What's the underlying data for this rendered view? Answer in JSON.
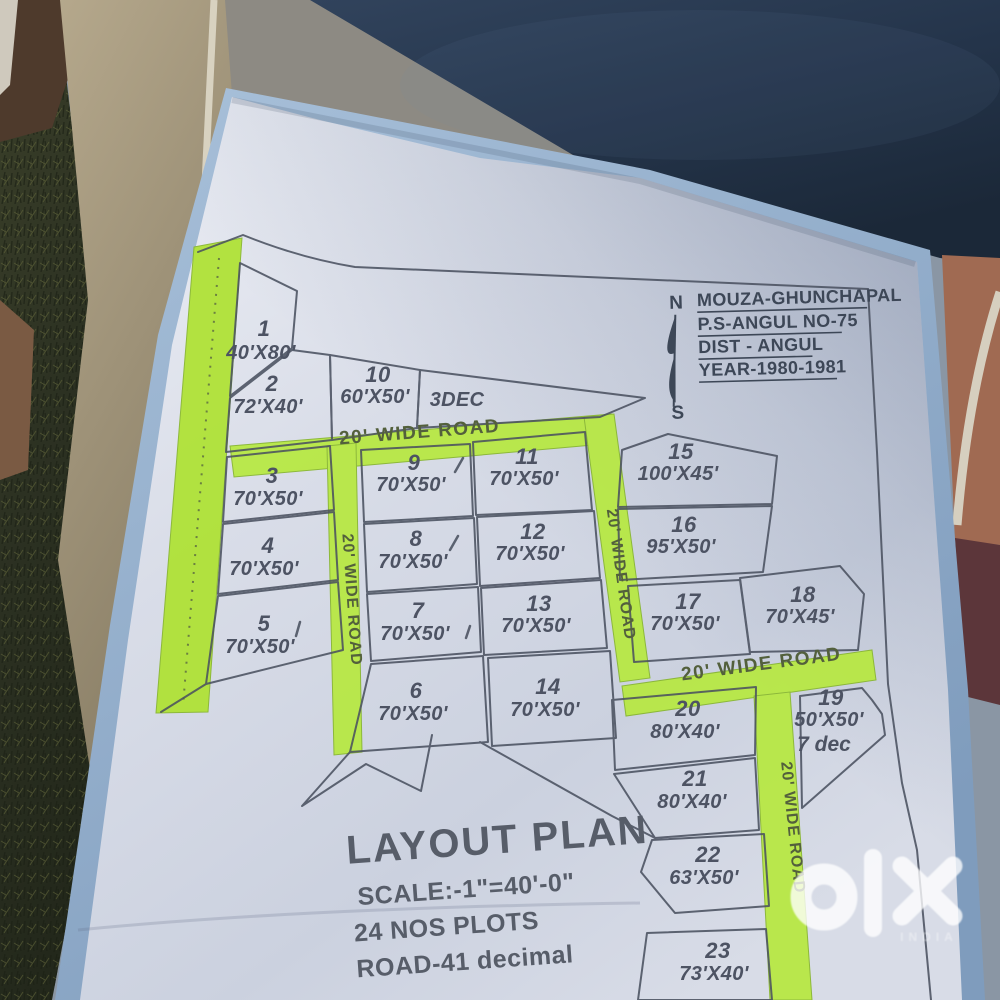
{
  "colors": {
    "highlight_green": "#b4e43b",
    "paper": "#dde1ec",
    "ink": "#4a5160",
    "fabric_navy": "#24344a",
    "grass_dark": "#2c3122",
    "chair_tan": "#ac9f84",
    "board_blue": "#9db7d2",
    "watermark_white": "#ffffff"
  },
  "title_block": {
    "north": "N",
    "south": "S",
    "line1": "MOUZA-GHUNCHAPAL",
    "line2": "P.S-ANGUL NO-75",
    "line3": "DIST - ANGUL",
    "line4": "YEAR-1980-1981"
  },
  "legend": {
    "title": "LAYOUT PLAN",
    "scale": "SCALE:-1\"=40'-0\"",
    "plots": "24 NOS PLOTS",
    "road": "ROAD-41 decimal"
  },
  "roads": [
    "20' WIDE ROAD",
    "20' WIDE ROAD",
    "20' WIDE ROAD",
    "20' WIDE ROAD",
    "20' WIDE ROAD"
  ],
  "plots": [
    {
      "no": "1",
      "size": "40'X80'"
    },
    {
      "no": "2",
      "size": "72'X40'"
    },
    {
      "no": "3",
      "size": "70'X50'"
    },
    {
      "no": "4",
      "size": "70'X50'"
    },
    {
      "no": "5",
      "size": "70'X50'"
    },
    {
      "no": "6",
      "size": "70'X50'"
    },
    {
      "no": "7",
      "size": "70'X50'"
    },
    {
      "no": "8",
      "size": "70'X50'"
    },
    {
      "no": "9",
      "size": "70'X50'"
    },
    {
      "no": "10",
      "size": "60'X50'"
    },
    {
      "no": "11",
      "size": "70'X50'"
    },
    {
      "no": "12",
      "size": "70'X50'"
    },
    {
      "no": "13",
      "size": "70'X50'"
    },
    {
      "no": "14",
      "size": "70'X50'"
    },
    {
      "no": "15",
      "size": "100'X45'"
    },
    {
      "no": "16",
      "size": "95'X50'"
    },
    {
      "no": "17",
      "size": "70'X50'"
    },
    {
      "no": "18",
      "size": "70'X45'"
    },
    {
      "no": "19",
      "size": "50'X50'",
      "extra": "7 dec"
    },
    {
      "no": "20",
      "size": "80'X40'"
    },
    {
      "no": "21",
      "size": "80'X40'"
    },
    {
      "no": "22",
      "size": "63'X50'"
    },
    {
      "no": "23",
      "size": "73'X40'"
    },
    {
      "no": "",
      "size": "3DEC"
    }
  ],
  "watermark": {
    "brand": "olx",
    "country": "INDIA"
  }
}
